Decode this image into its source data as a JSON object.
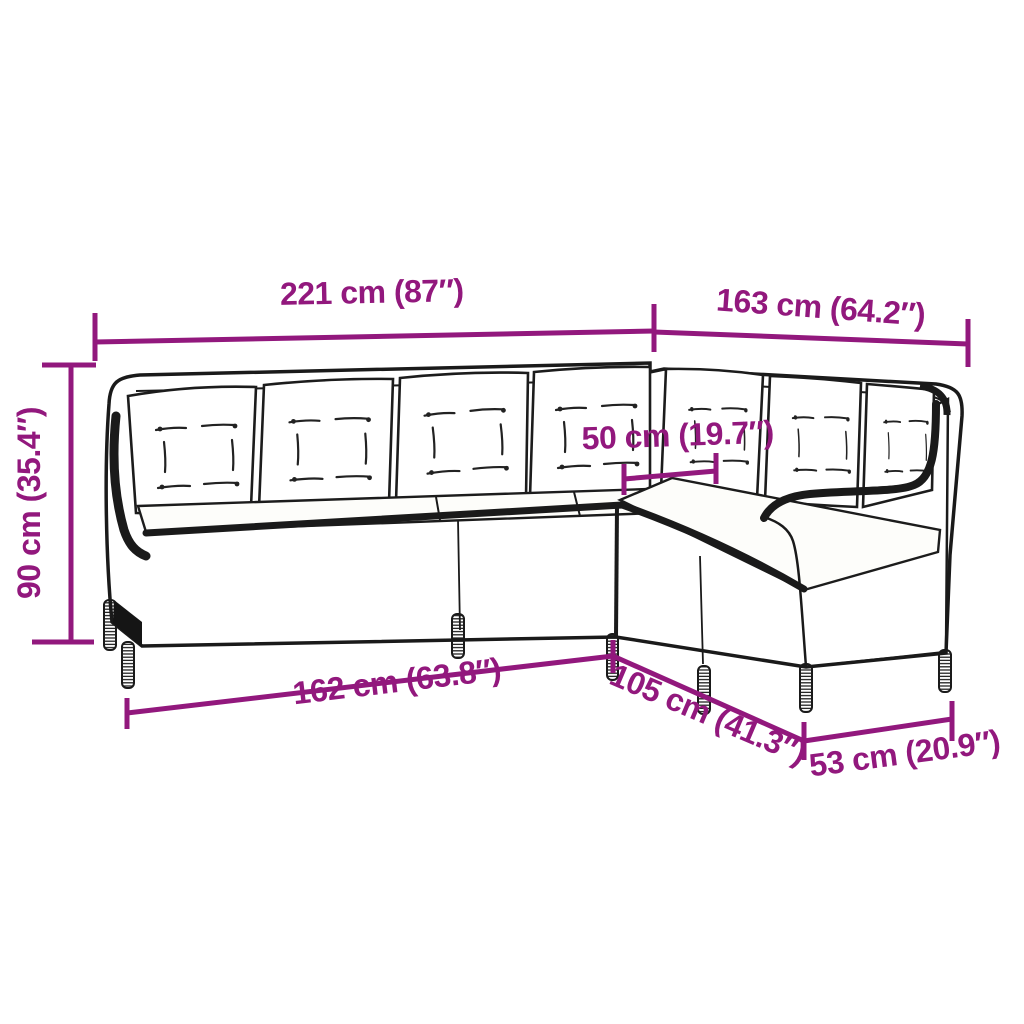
{
  "diagram": {
    "kind": "furniture-dimension-line-drawing",
    "subject": "L-shaped poly rattan corner sofa with back and seat cushions",
    "background_color": "#ffffff",
    "accent_color": "#92187D",
    "line_art_color": "#1a1a1a",
    "dims": {
      "width_left": {
        "label": "221 cm (87″)"
      },
      "width_right": {
        "label": "163 cm (64.2″)"
      },
      "height": {
        "label": "90 cm (35.4″)"
      },
      "seat_depth": {
        "label": "50 cm (19.7″)"
      },
      "depth_left": {
        "label": "162 cm (63.8″)"
      },
      "depth_diagonal": {
        "label": "105 cm (41.3″)"
      },
      "depth_right": {
        "label": "53 cm (20.9″)"
      }
    }
  }
}
